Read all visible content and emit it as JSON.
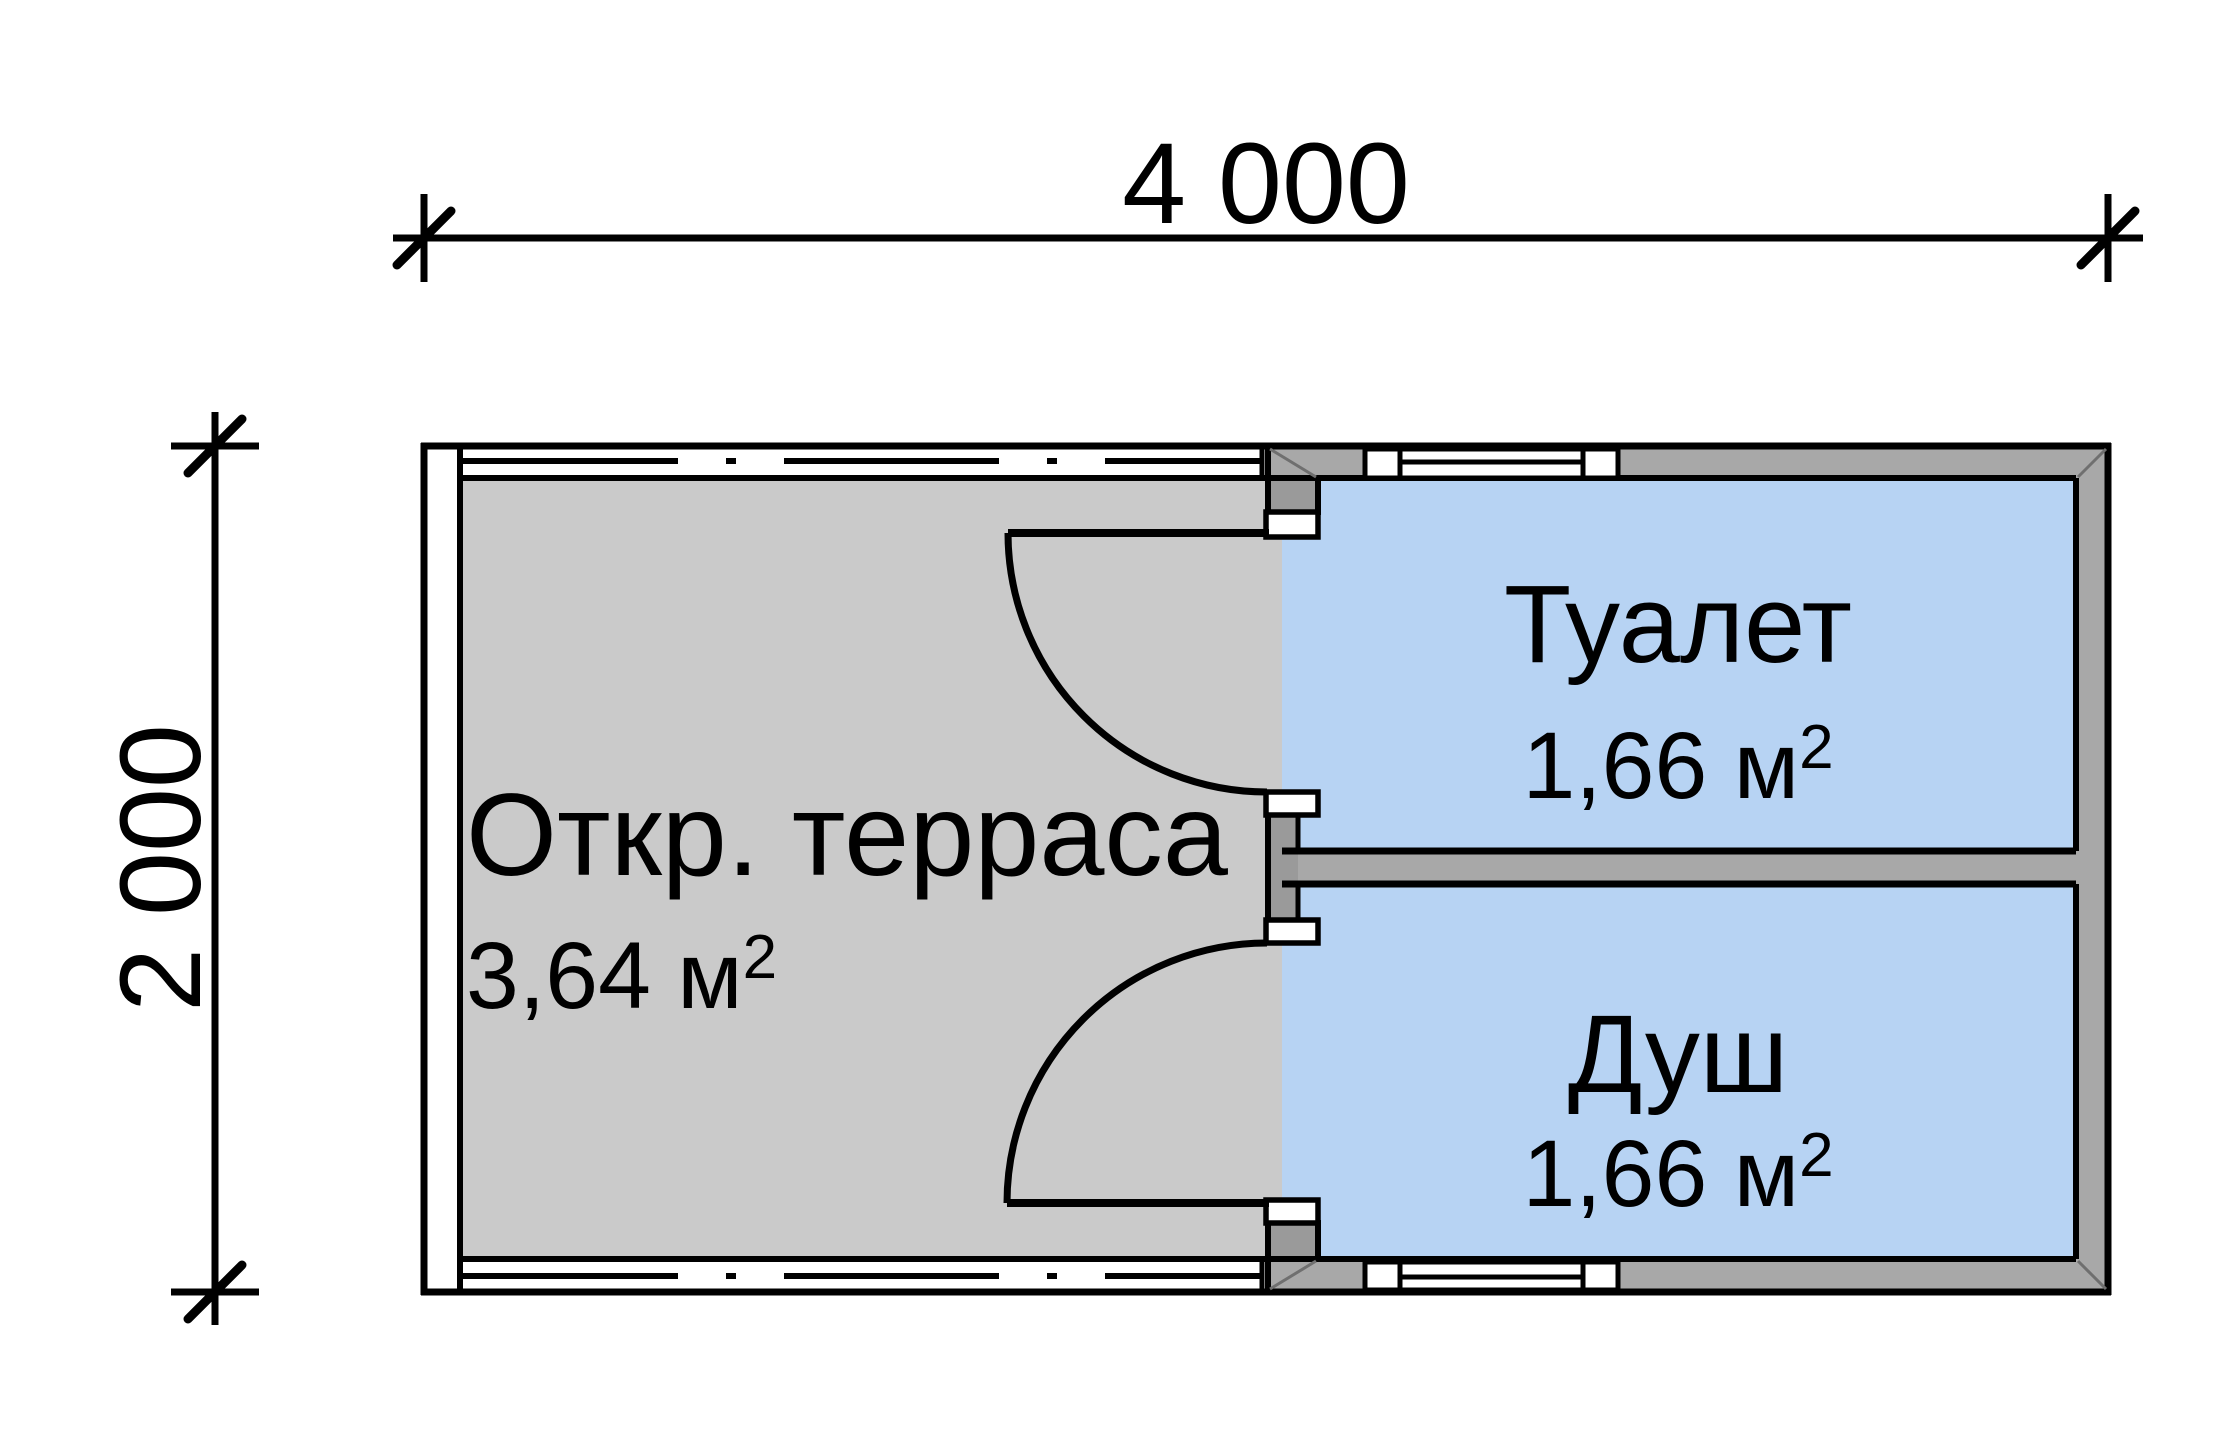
{
  "plan": {
    "type": "floor-plan",
    "dimensions": {
      "horizontal": "4 000",
      "vertical": "2 000"
    },
    "rooms": {
      "terrace": {
        "name": "Откр. терраса",
        "area": "3,64 м",
        "area_sup": "2"
      },
      "toilet": {
        "name": "Туалет",
        "area": "1,66 м",
        "area_sup": "2"
      },
      "shower": {
        "name": "Душ",
        "area": "1,66 м",
        "area_sup": "2"
      }
    },
    "colors": {
      "terrace_floor": "#cacaca",
      "room_fill": "#b7d3f3",
      "wall_fill": "#a8a8a8",
      "wall_dark": "#9a9a9a",
      "line": "#000000"
    }
  }
}
